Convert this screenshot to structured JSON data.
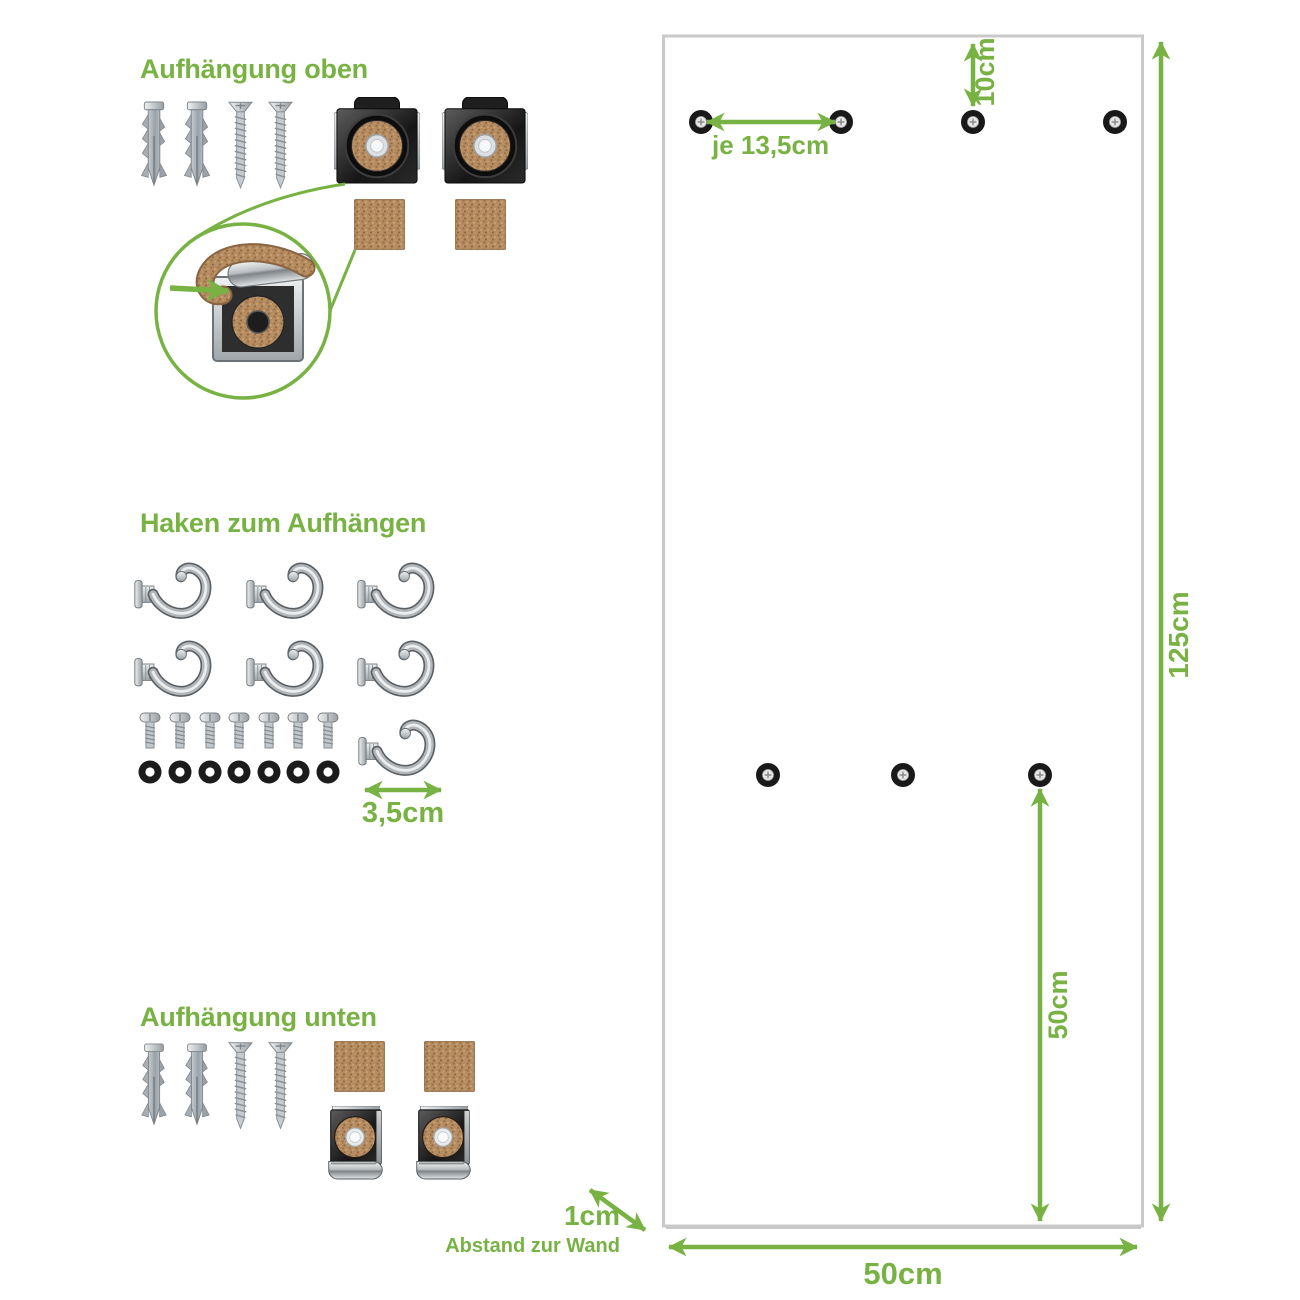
{
  "meta": {
    "accent_color": "#77b243",
    "panel_border_color": "#c9c9c9",
    "cork_color": "#b58b60",
    "icon_names": [
      "wall-plug-icon",
      "screw-icon",
      "mounting-clip-icon",
      "cork-pad-icon",
      "hook-icon",
      "bolt-icon",
      "washer-icon",
      "mounting-hole-icon",
      "magnifier-circle-icon",
      "dimension-arrow-icon"
    ]
  },
  "sections": {
    "top_mount": {
      "title": "Aufhängung oben"
    },
    "hooks": {
      "title": "Haken zum Aufhängen",
      "hook_width_label": "3,5cm"
    },
    "bottom_mount": {
      "title": "Aufhängung unten"
    }
  },
  "panel": {
    "hole_spacing_label": "je 13,5cm",
    "top_offset_label": "10cm",
    "height_label": "125cm",
    "lower_hole_to_bottom_label": "50cm",
    "width_label": "50cm",
    "wall_gap_label": "1cm",
    "wall_gap_caption": "Abstand zur Wand"
  }
}
